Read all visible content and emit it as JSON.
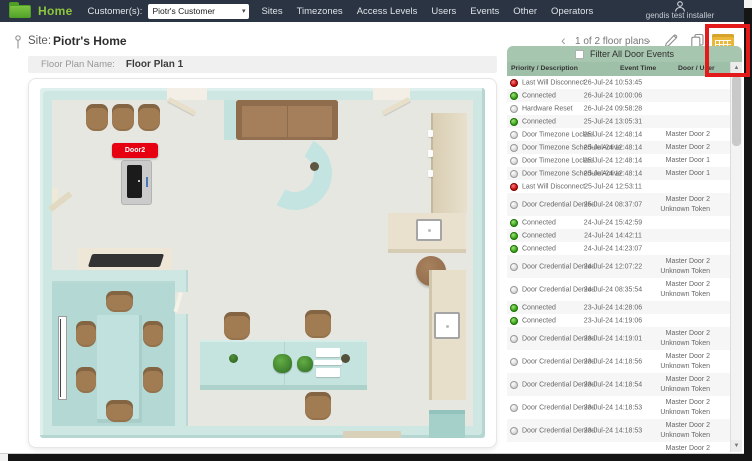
{
  "topbar": {
    "logo_label": "Home",
    "customer_label": "Customer(s):",
    "customer_value": "Piotr's Customer",
    "menu": [
      "Sites",
      "Timezones",
      "Access Levels",
      "Users",
      "Events",
      "Other",
      "Operators"
    ],
    "user": "gendis test installer"
  },
  "site_header": {
    "site_label": "Site:",
    "site_name": "Piotr's Home",
    "pagination": "1 of 2 floor plans",
    "prev_icon": "‹",
    "next_icon": "›"
  },
  "floor_plan": {
    "name_label": "Floor Plan Name:",
    "name_value": "Floor Plan 1",
    "door_marker": "Door2"
  },
  "events_panel": {
    "filter_label": "Filter All Door Events",
    "columns": [
      "Priority / Description",
      "Event Time",
      "Door / User"
    ],
    "rows": [
      {
        "priority": "red",
        "description": "Last Will Disconnect",
        "time": "26-Jul-24 10:53:45",
        "door": []
      },
      {
        "priority": "green",
        "description": "Connected",
        "time": "26-Jul-24 10:00:06",
        "door": []
      },
      {
        "priority": "gray",
        "description": "Hardware Reset",
        "time": "26-Jul-24 09:58:28",
        "door": []
      },
      {
        "priority": "green",
        "description": "Connected",
        "time": "25-Jul-24 13:05:31",
        "door": []
      },
      {
        "priority": "gray",
        "description": "Door Timezone Locked",
        "time": "25-Jul-24 12:48:14",
        "door": [
          "Master Door 2"
        ]
      },
      {
        "priority": "gray",
        "description": "Door Timezone Schedule Active",
        "time": "25-Jul-24 12:48:14",
        "door": [
          "Master Door 2"
        ]
      },
      {
        "priority": "gray",
        "description": "Door Timezone Locked",
        "time": "25-Jul-24 12:48:14",
        "door": [
          "Master Door 1"
        ]
      },
      {
        "priority": "gray",
        "description": "Door Timezone Schedule Active",
        "time": "25-Jul-24 12:48:14",
        "door": [
          "Master Door 1"
        ]
      },
      {
        "priority": "red",
        "description": "Last Will Disconnect",
        "time": "25-Jul-24 12:53:11",
        "door": []
      },
      {
        "priority": "gray",
        "description": "Door Credential Denied",
        "time": "25-Jul-24 08:37:07",
        "door": [
          "Master Door 2",
          "Unknown Token"
        ]
      },
      {
        "priority": "green",
        "description": "Connected",
        "time": "24-Jul-24 15:42:59",
        "door": []
      },
      {
        "priority": "green",
        "description": "Connected",
        "time": "24-Jul-24 14:42:11",
        "door": []
      },
      {
        "priority": "green",
        "description": "Connected",
        "time": "24-Jul-24 14:23:07",
        "door": []
      },
      {
        "priority": "gray",
        "description": "Door Credential Denied",
        "time": "24-Jul-24 12:07:22",
        "door": [
          "Master Door 2",
          "Unknown Token"
        ]
      },
      {
        "priority": "gray",
        "description": "Door Credential Denied",
        "time": "24-Jul-24 08:35:54",
        "door": [
          "Master Door 2",
          "Unknown Token"
        ]
      },
      {
        "priority": "green",
        "description": "Connected",
        "time": "23-Jul-24 14:28:06",
        "door": []
      },
      {
        "priority": "green",
        "description": "Connected",
        "time": "23-Jul-24 14:19:06",
        "door": []
      },
      {
        "priority": "gray",
        "description": "Door Credential Denied",
        "time": "23-Jul-24 14:19:01",
        "door": [
          "Master Door 2",
          "Unknown Token"
        ]
      },
      {
        "priority": "gray",
        "description": "Door Credential Denied",
        "time": "23-Jul-24 14:18:56",
        "door": [
          "Master Door 2",
          "Unknown Token"
        ]
      },
      {
        "priority": "gray",
        "description": "Door Credential Denied",
        "time": "23-Jul-24 14:18:54",
        "door": [
          "Master Door 2",
          "Unknown Token"
        ]
      },
      {
        "priority": "gray",
        "description": "Door Credential Denied",
        "time": "23-Jul-24 14:18:53",
        "door": [
          "Master Door 2",
          "Unknown Token"
        ]
      },
      {
        "priority": "gray",
        "description": "Door Credential Denied",
        "time": "23-Jul-24 14:18:53",
        "door": [
          "Master Door 2",
          "Unknown Token"
        ]
      },
      {
        "priority": "",
        "description": "",
        "time": "",
        "door": [
          "Master Door 2"
        ],
        "partial": true
      }
    ]
  },
  "icons": {
    "scroll_up": "▲",
    "scroll_down": "▼",
    "select_caret": "▾"
  },
  "colors": {
    "topbar_bg": "#2b3442",
    "logo_green": "#8dc63f",
    "panel_green": "#a7c6af",
    "annotation_red": "#e31a1a",
    "door_marker_red": "#e60012",
    "dot_red": "#c00808",
    "dot_green": "#2f9e0e",
    "dot_gray": "#cfcfcf",
    "wall_teal": "#cfe7e3"
  }
}
